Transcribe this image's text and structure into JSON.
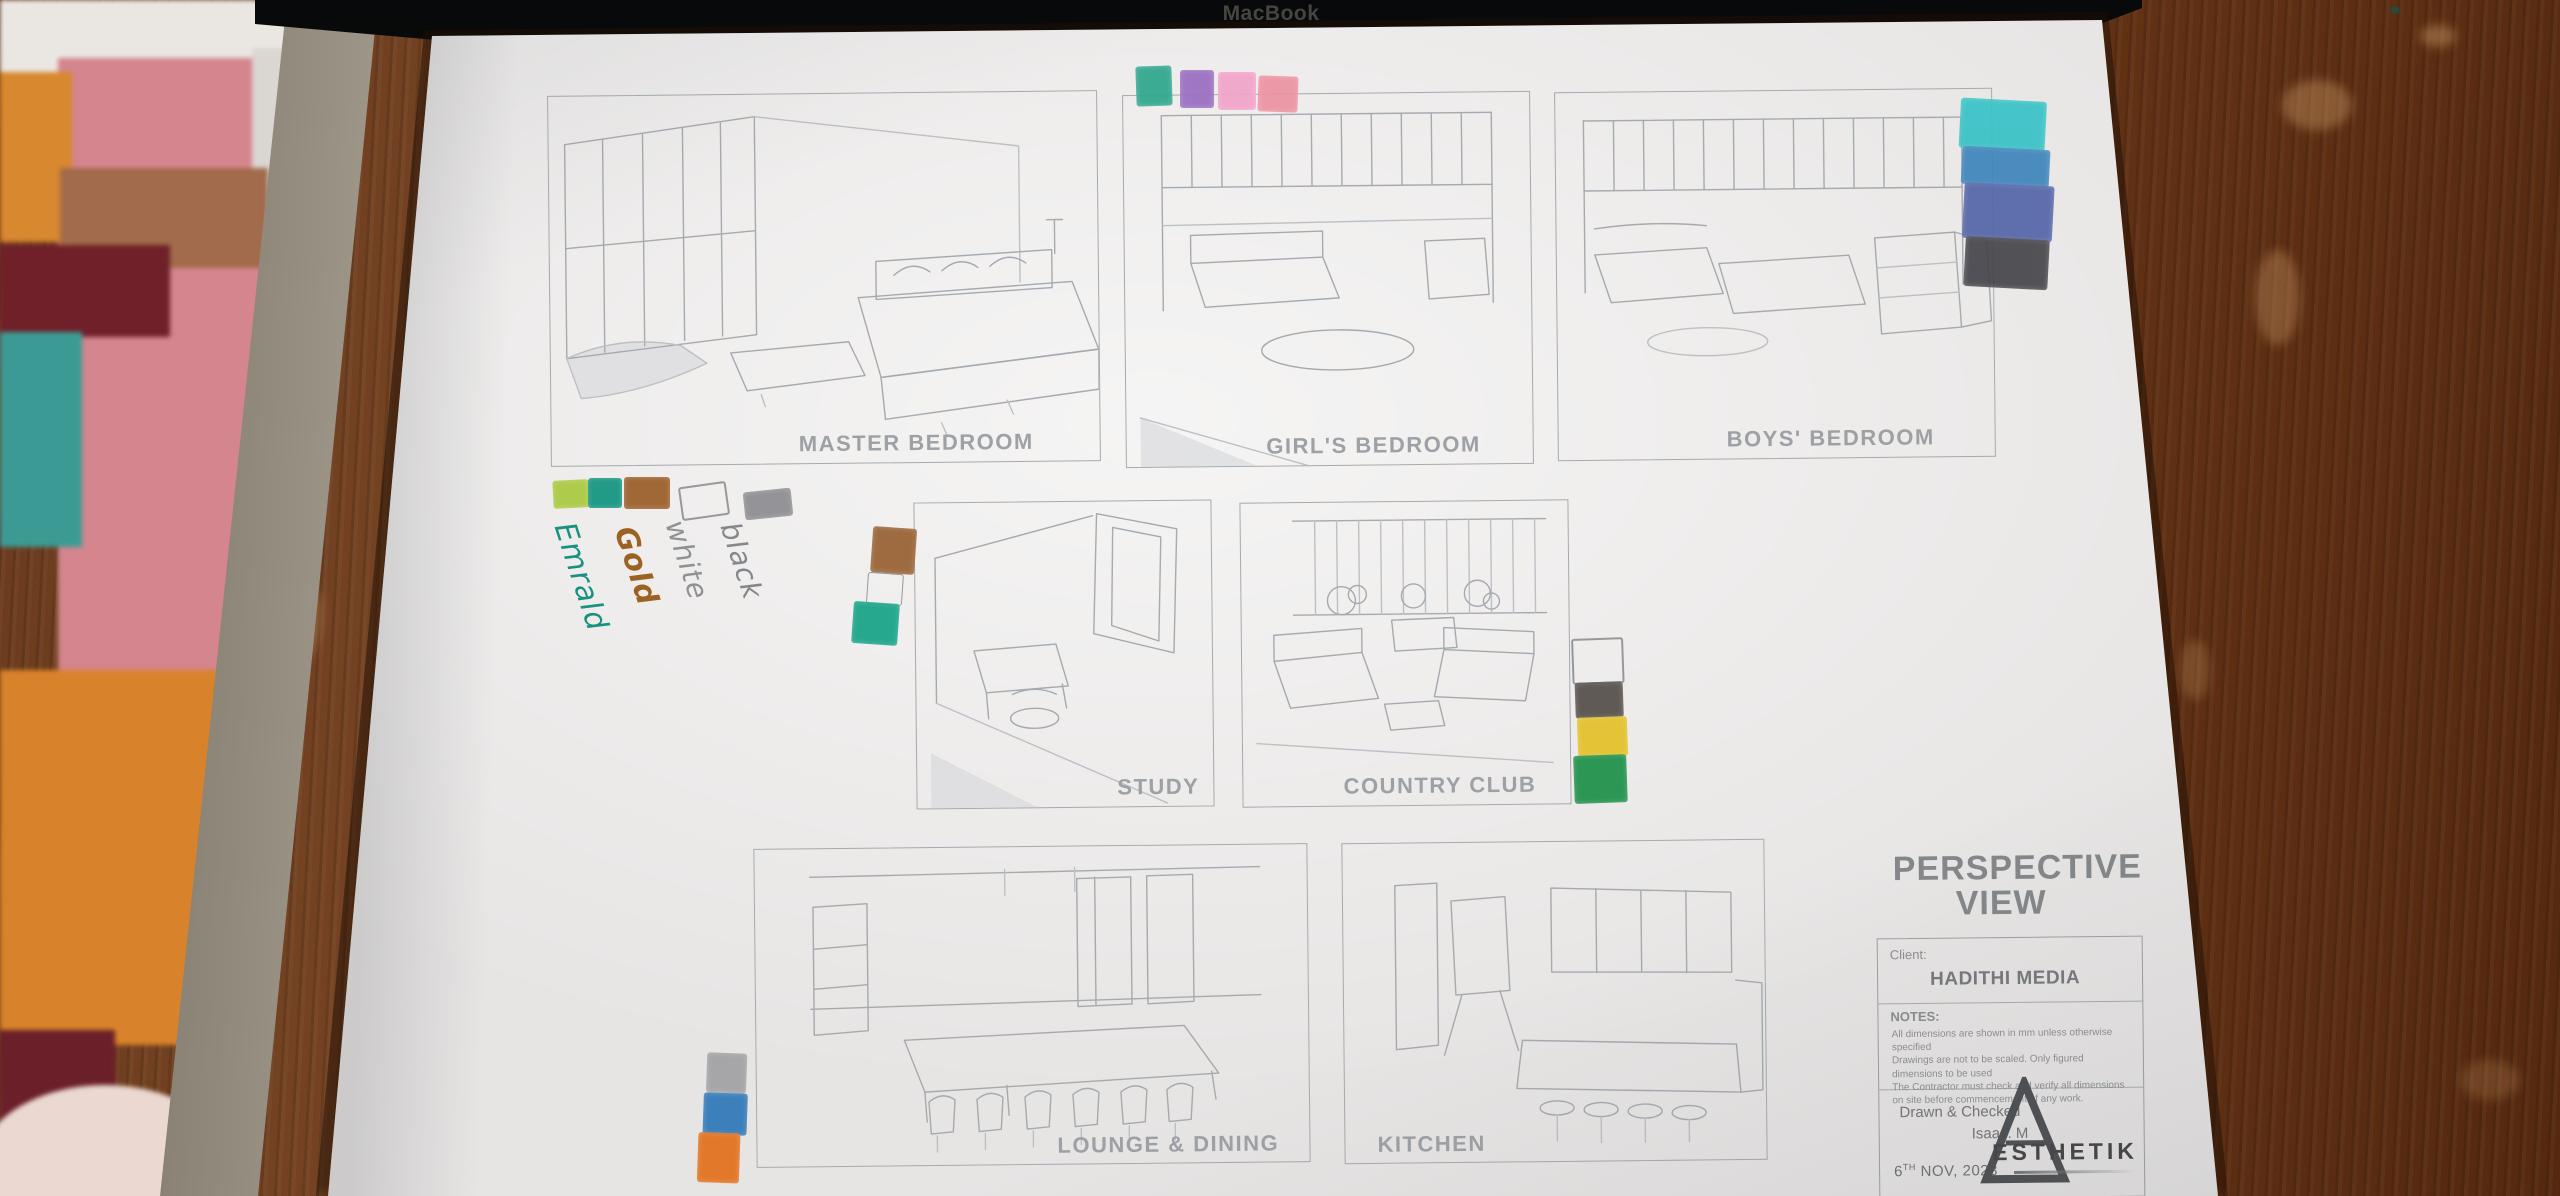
{
  "scene": {
    "macbook_label": "MacBook"
  },
  "sheet": {
    "panels": [
      {
        "label": "MASTER BEDROOM"
      },
      {
        "label": "GIRL'S BEDROOM"
      },
      {
        "label": "BOYS' BEDROOM"
      },
      {
        "label": "STUDY"
      },
      {
        "label": "COUNTRY CLUB"
      },
      {
        "label": "LOUNGE & DINING"
      },
      {
        "label": "KITCHEN"
      }
    ],
    "title_block": {
      "title": "PERSPECTIVE VIEW",
      "client_label": "Client:",
      "client_name": "HADITHI MEDIA",
      "notes_label": "NOTES:",
      "notes": [
        "All dimensions are shown in mm unless otherwise specified",
        "Drawings are not to be scaled. Only figured dimensions to be used",
        "The Contractor must check and verify all dimensions on site before commencement of any work."
      ],
      "drawn_label": "Drawn & Checked",
      "drawn_by": "Isaac. M",
      "date_day": "6",
      "date_suffix": "TH",
      "date_rest": " NOV, 2023",
      "logo_text": "ESTHETIK"
    },
    "legend": {
      "items": [
        {
          "label": "Emrald",
          "ink": "#16927e"
        },
        {
          "label": "Gold",
          "ink": "#9c6224"
        },
        {
          "label": "white",
          "ink": "#8f9295"
        },
        {
          "label": "black",
          "ink": "#85888b"
        }
      ]
    },
    "swatches": {
      "top": [
        {
          "name": "teal",
          "color": "#2fa78d"
        },
        {
          "name": "purple",
          "color": "#9a6ec1"
        },
        {
          "name": "pink",
          "color": "#f2a4c9"
        },
        {
          "name": "salmon",
          "color": "#ec93a2"
        }
      ],
      "right_column": [
        {
          "name": "turquoise",
          "color": "#39c2c6"
        },
        {
          "name": "blue",
          "color": "#3f85bb"
        },
        {
          "name": "indigo",
          "color": "#5565a8"
        },
        {
          "name": "dark-gray",
          "color": "#46464c"
        }
      ],
      "legend_row": [
        {
          "name": "lime",
          "color": "#aaca40"
        },
        {
          "name": "teal",
          "color": "#12947f"
        },
        {
          "name": "brown",
          "color": "#9b5e29"
        },
        {
          "name": "white",
          "color": "#f1efec"
        },
        {
          "name": "gray",
          "color": "#8e8e92"
        }
      ],
      "study_column": [
        {
          "name": "brown",
          "color": "#986233"
        },
        {
          "name": "white",
          "color": "#f1efec"
        },
        {
          "name": "teal",
          "color": "#17a388"
        }
      ],
      "country_club_column": [
        {
          "name": "white",
          "color": "#f1efec"
        },
        {
          "name": "black",
          "color": "#55504b"
        },
        {
          "name": "yellow",
          "color": "#e4c229"
        },
        {
          "name": "green",
          "color": "#1e9049"
        }
      ],
      "bottom_left_column": [
        {
          "name": "gray",
          "color": "#97979b"
        },
        {
          "name": "blue",
          "color": "#3079b8"
        },
        {
          "name": "orange",
          "color": "#e2711c"
        }
      ]
    }
  }
}
